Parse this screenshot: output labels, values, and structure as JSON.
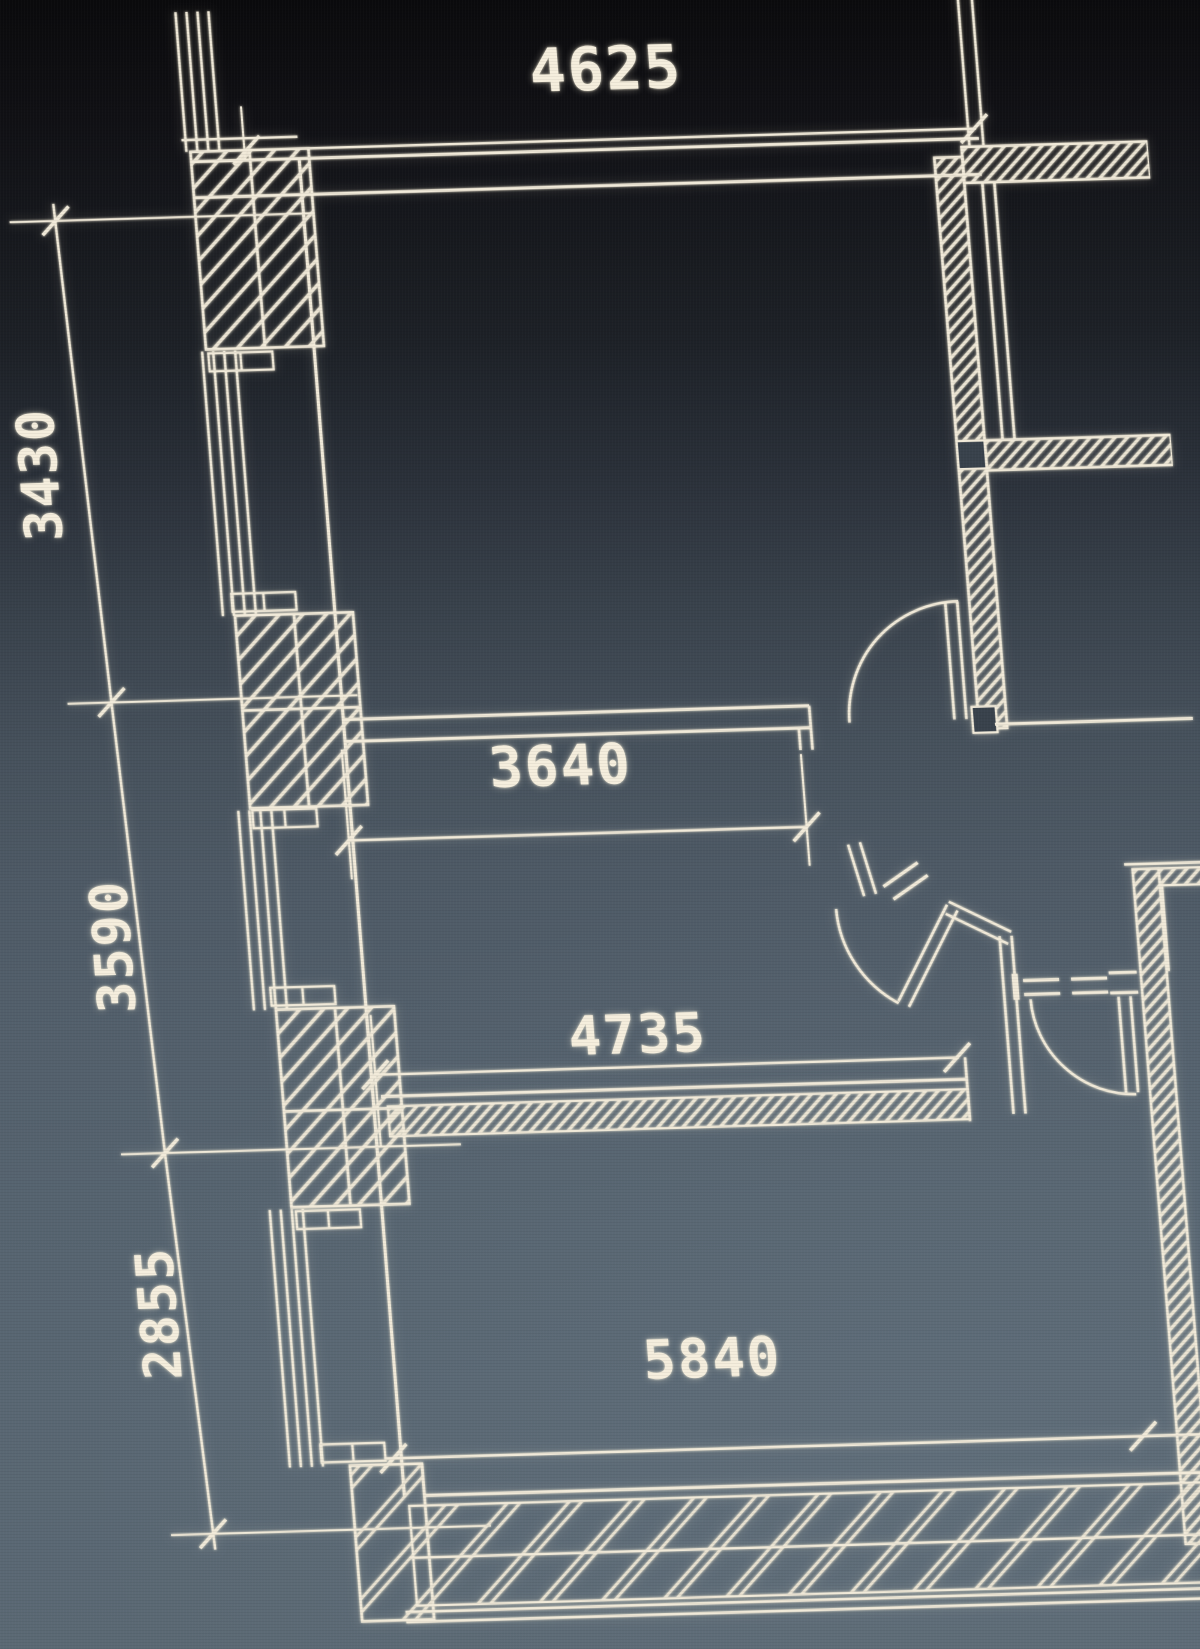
{
  "drawing": {
    "type": "architectural-floor-plan",
    "view": "photo-of-cad-screen",
    "dimensions_mm": {
      "top": "4625",
      "left_upper": "3430",
      "left_middle": "3590",
      "left_lower": "2855",
      "interior_upper": "3640",
      "interior_lower": "4735",
      "bottom": "5840"
    },
    "colors": {
      "line": "#f1ead9",
      "text": "#f5eedd",
      "screen_top": "#0a0a0c",
      "screen_bottom": "#5b6974"
    }
  }
}
